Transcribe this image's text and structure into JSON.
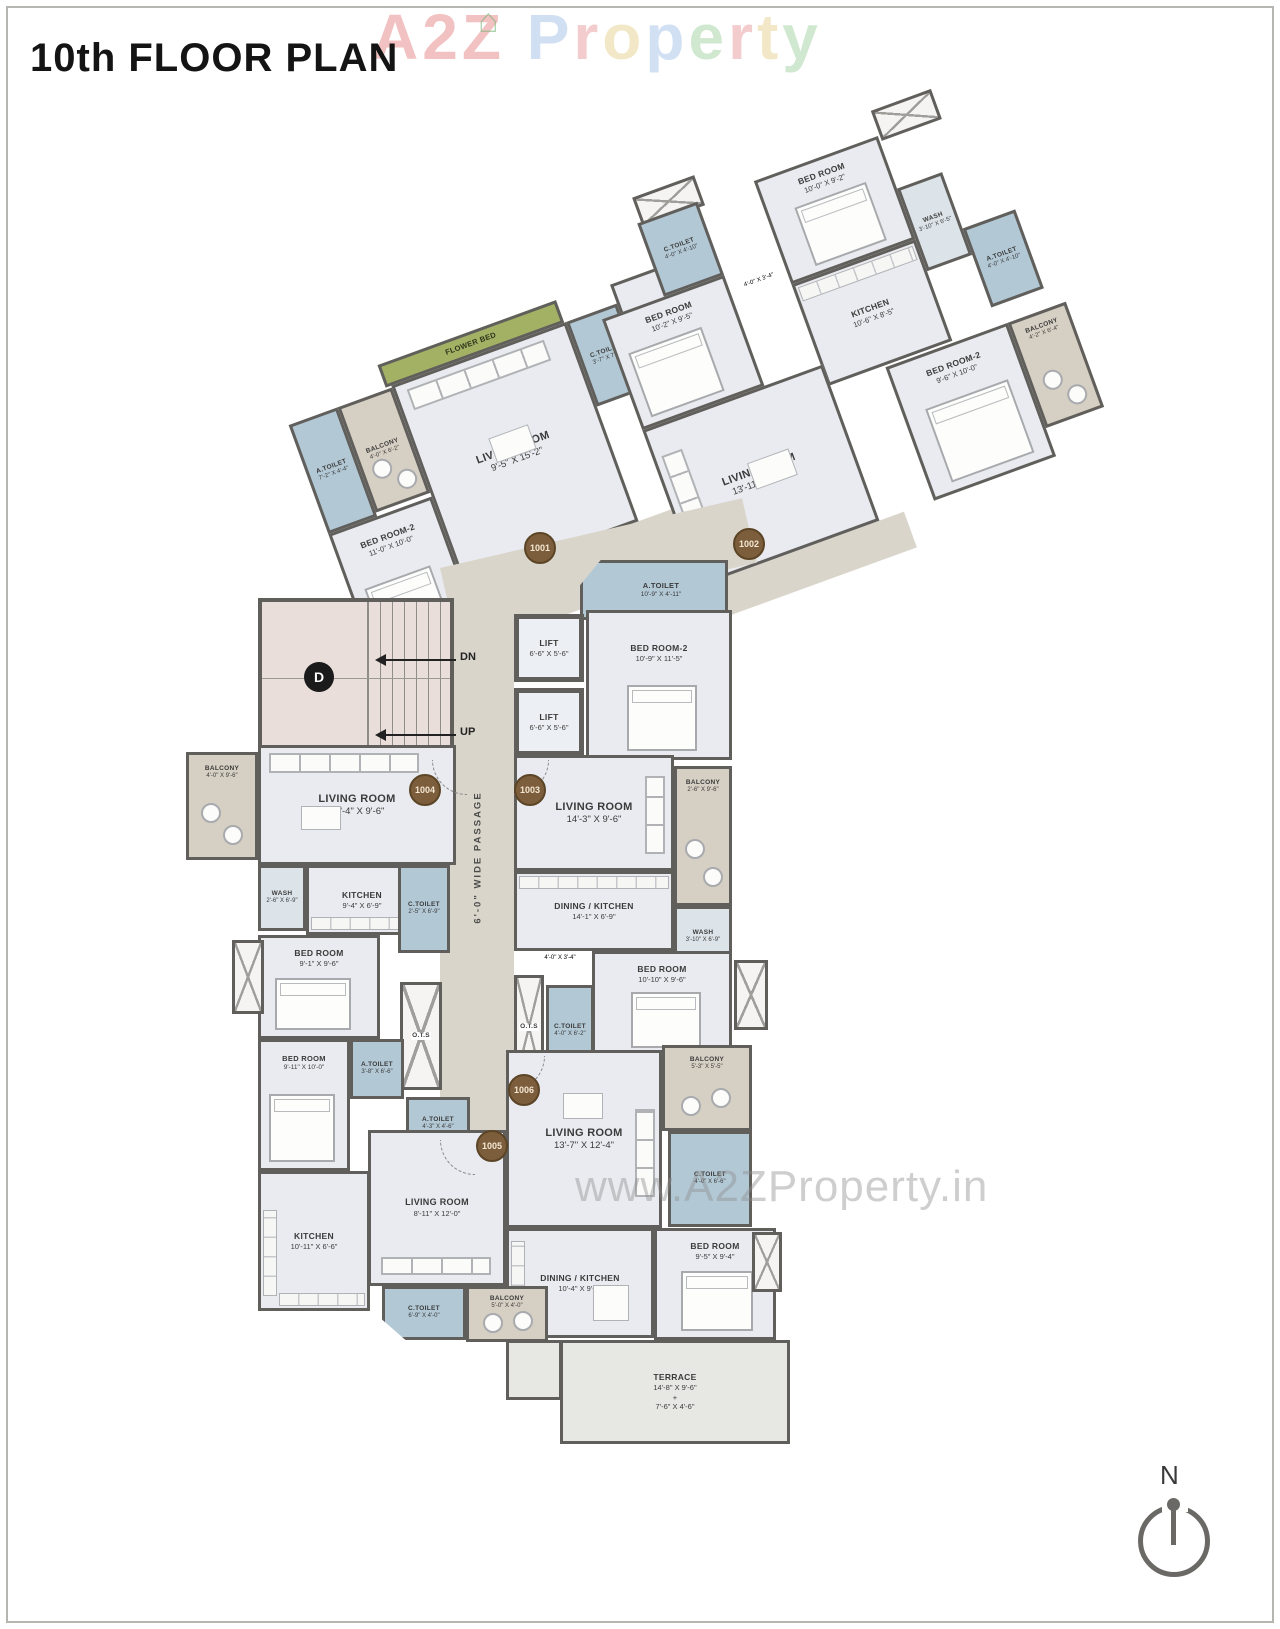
{
  "title": "10th FLOOR PLAN",
  "watermarks": {
    "top_text": "A2Z Property",
    "letter_colors": [
      "#e98f8f",
      "#e98f8f",
      "#e98f8f",
      "",
      "#adc6ea",
      "#eaa6a6",
      "#e8d79b",
      "#aec7ea",
      "#a9d6a9",
      "#eaa6a6",
      "#e8d79b",
      "#a9d6a9"
    ],
    "house_glyph": "⌂",
    "bottom": "www.A2ZProperty.in"
  },
  "compass_label": "N",
  "colors": {
    "wall": "#615f5b",
    "room": "#e9ebf0",
    "toilet": "#b2c8d5",
    "balcony": "#d6cfc3",
    "flower_bed": "#a3b165",
    "stair": "#eadedb",
    "passage": "#dad5cb",
    "badge": "#7d5e3c"
  },
  "core": {
    "stair_label": "D",
    "dn": "DN",
    "up": "UP",
    "lift1": {
      "name": "LIFT",
      "dims": "6'-6\" X 5'-6\""
    },
    "lift2": {
      "name": "LIFT",
      "dims": "6'-6\" X 5'-6\""
    },
    "passage_top": "5'-0\" WIDE PASSAGE",
    "passage_main": "6'-0\" WIDE PASSAGE",
    "ots_a": "O.T.S",
    "ots_b": "O.T.S",
    "atoilet_common": {
      "name": "A.TOILET",
      "dims": "10'-9\" X 4'-11\""
    }
  },
  "badges": {
    "u1001": "1001",
    "u1002": "1002",
    "u1003": "1003",
    "u1004": "1004",
    "u1005": "1005",
    "u1006": "1006"
  },
  "unit_1001": {
    "flower_bed": {
      "name": "FLOWER BED"
    },
    "atoilet": {
      "name": "A.TOILET",
      "dims": "7'-2\" X 4'-4\""
    },
    "balcony": {
      "name": "BALCONY",
      "dims": "4'-0\" X 6'-2\""
    },
    "bedroom2": {
      "name": "BED ROOM-2",
      "dims": "11'-0\" X 10'-0\""
    },
    "living": {
      "name": "LIVING ROOM",
      "dims": "9'-5\" X 15'-2\""
    },
    "ctoilet": {
      "name": "C.TOILET",
      "dims": "3'-7\" X 7'-0\""
    },
    "kitchen": {
      "name": "KITCHEN",
      "dims": "7'-0\" X 9'-2\""
    },
    "dining": {
      "name": "DINING",
      "dims": "7'-3\" X 7'-0\""
    }
  },
  "unit_1002": {
    "ctoilet": {
      "name": "C.TOILET",
      "dims": "4'-0\" X 4'-10\""
    },
    "bedroom_a": {
      "name": "BED ROOM",
      "dims": "10'-2\" X 9'-5\""
    },
    "bedroom_b": {
      "name": "BED ROOM",
      "dims": "10'-0\" X 9'-2\""
    },
    "corridor": {
      "dims": "4'-0\" X 3'-4\""
    },
    "wash": {
      "name": "WASH",
      "dims": "3'-10\" X 6'-5\""
    },
    "kitchen": {
      "name": "KITCHEN",
      "dims": "10'-6\" X 8'-5\""
    },
    "atoilet": {
      "name": "A.TOILET",
      "dims": "4'-0\" X 4'-10\""
    },
    "bedroom2": {
      "name": "BED ROOM-2",
      "dims": "9'-6\" X 10'-0\""
    },
    "balcony": {
      "name": "BALCONY",
      "dims": "4'-2\" X 6'-4\""
    },
    "living": {
      "name": "LIVING ROOM",
      "dims": "13'-11\" X 12'-2\""
    }
  },
  "unit_1003": {
    "bedroom2": {
      "name": "BED ROOM-2",
      "dims": "10'-9\" X 11'-5\""
    },
    "living": {
      "name": "LIVING ROOM",
      "dims": "14'-3\" X 9'-6\""
    },
    "balcony": {
      "name": "BALCONY",
      "dims": "2'-6\" X 9'-6\""
    },
    "dining_kitchen": {
      "name": "DINING / KITCHEN",
      "dims": "14'-1\" X 6'-9\""
    },
    "wash": {
      "name": "WASH",
      "dims": "3'-10\" X 6'-9\""
    },
    "corridor": {
      "dims": "4'-0\" X 3'-4\""
    },
    "bedroom": {
      "name": "BED ROOM",
      "dims": "10'-10\" X 9'-6\""
    },
    "ctoilet": {
      "name": "C.TOILET",
      "dims": "4'-0\" X 6'-2\""
    }
  },
  "unit_1004": {
    "balcony": {
      "name": "BALCONY",
      "dims": "4'-0\" X 9'-6\""
    },
    "living": {
      "name": "LIVING ROOM",
      "dims": "17'-4\" X 9'-6\""
    },
    "wash": {
      "name": "WASH",
      "dims": "2'-6\" X 6'-9\""
    },
    "kitchen": {
      "name": "KITCHEN",
      "dims": "9'-4\" X 6'-9\""
    },
    "ctoilet": {
      "name": "C.TOILET",
      "dims": "2'-5\" X 6'-9\""
    },
    "bedroom": {
      "name": "BED ROOM",
      "dims": "9'-1\" X 9'-6\""
    },
    "atoilet": {
      "name": "A.TOILET",
      "dims": "3'-8\" X 6'-6\""
    }
  },
  "unit_1005": {
    "bedroom": {
      "name": "BED ROOM",
      "dims": "9'-11\" X 10'-0\""
    },
    "atoilet": {
      "name": "A.TOILET",
      "dims": "4'-3\" X 4'-6\""
    },
    "living": {
      "name": "LIVING ROOM",
      "dims": "8'-11\" X 12'-0\""
    },
    "kitchen": {
      "name": "KITCHEN",
      "dims": "10'-11\" X 6'-6\""
    },
    "ctoilet": {
      "name": "C.TOILET",
      "dims": "6'-9\" X 4'-0\""
    },
    "balcony": {
      "name": "BALCONY",
      "dims": "5'-0\" X 4'-0\""
    }
  },
  "unit_1006": {
    "living": {
      "name": "LIVING ROOM",
      "dims": "13'-7\" X 12'-4\""
    },
    "balcony": {
      "name": "BALCONY",
      "dims": "5'-3\" X 5'-5\""
    },
    "ctoilet": {
      "name": "C.TOILET",
      "dims": "4'-0\" X 6'-6\""
    },
    "dining_kitchen": {
      "name": "DINING / KITCHEN",
      "dims": "10'-4\" X 9'-4\""
    },
    "bedroom": {
      "name": "BED ROOM",
      "dims": "9'-5\" X 9'-4\""
    },
    "terrace": {
      "name": "TERRACE",
      "dims": "14'-8\" X 9'-6\"",
      "plus": "+",
      "dims2": "7'-6\" X 4'-6\""
    }
  }
}
